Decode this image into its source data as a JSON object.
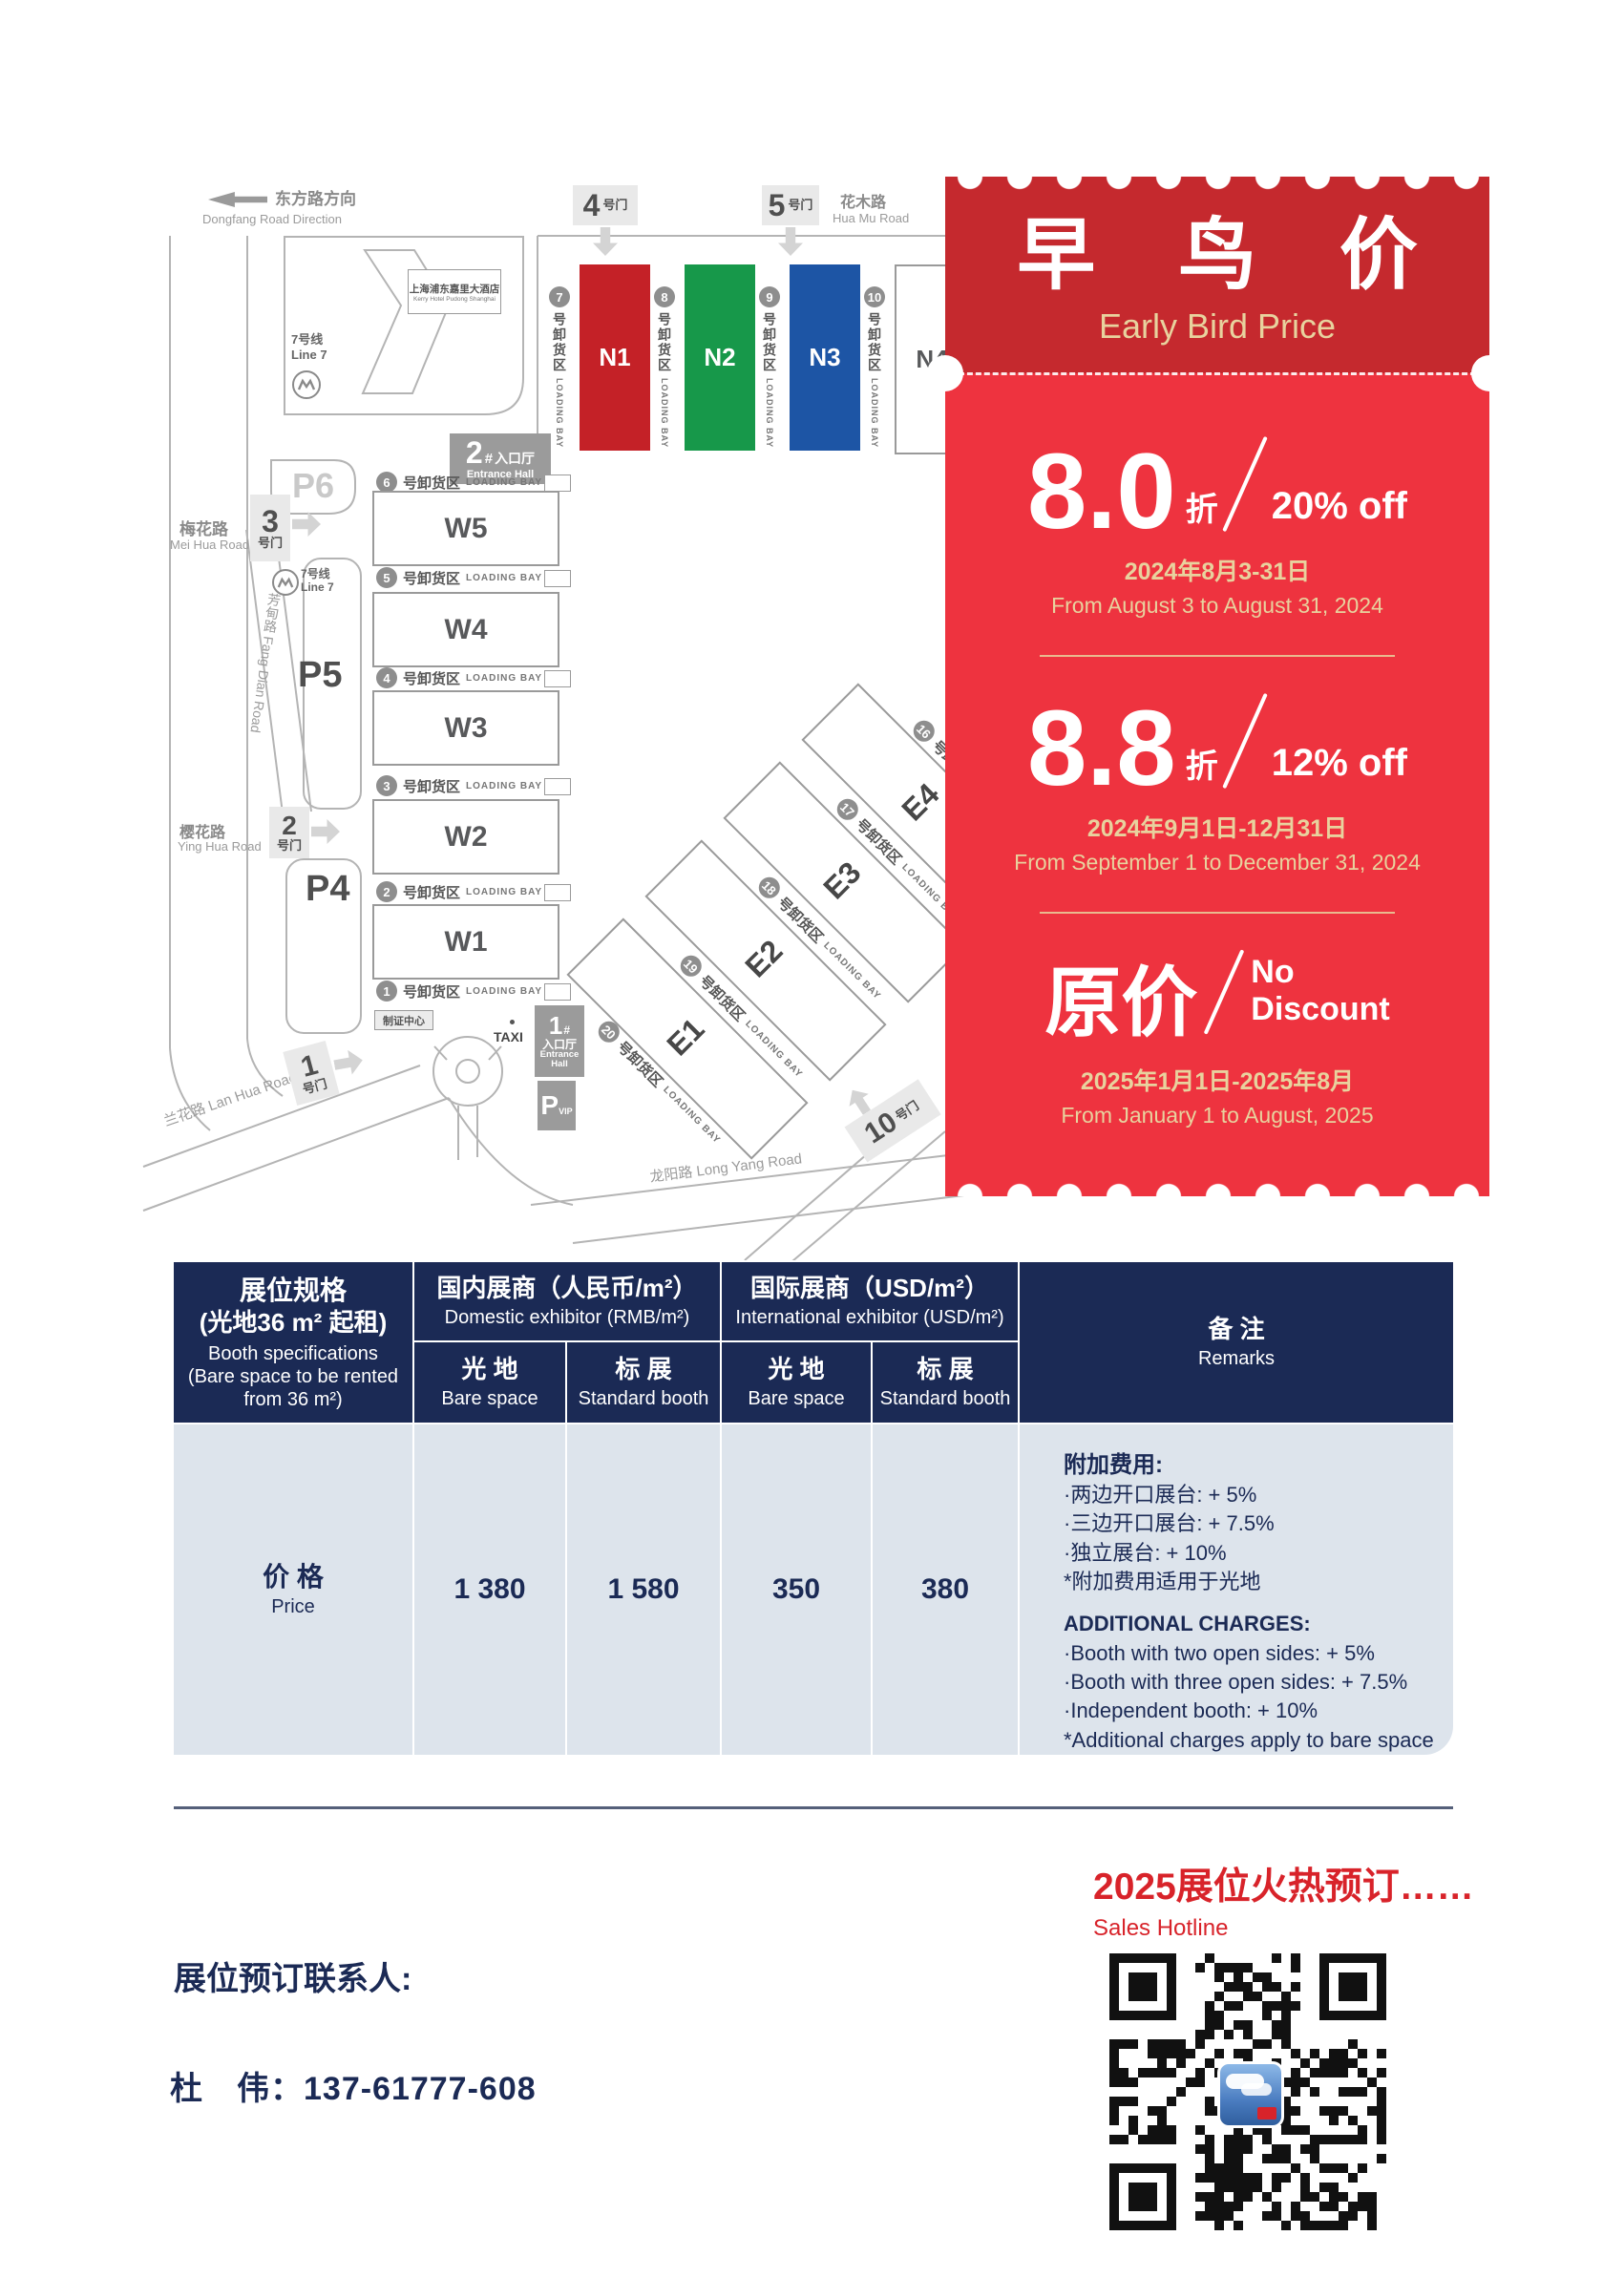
{
  "map": {
    "direction": {
      "zh": "东方路方向",
      "en": "Dongfang Road Direction"
    },
    "hotel": {
      "zh": "上海浦东嘉里大酒店",
      "en": "Kerry Hotel Pudong Shanghai"
    },
    "line7": {
      "zh": "7号线",
      "en": "Line 7"
    },
    "roads": {
      "huamu_zh": "花木路",
      "huamu_en": "Hua Mu Road",
      "meihua_zh": "梅花路",
      "meihua_en": "Mei Hua Road",
      "yinghua_zh": "樱花路",
      "yinghua_en": "Ying Hua Road",
      "lanhua": "兰花路 Lan Hua Road",
      "fangdian": "芳甸路 Fang Dian Road",
      "longyang": "龙阳路 Long Yang Road"
    },
    "gates": {
      "g1": {
        "num": "1",
        "suffix": "号门"
      },
      "g2": {
        "num": "2",
        "suffix": "号门"
      },
      "g3": {
        "num": "3",
        "suffix": "号门"
      },
      "g4": {
        "num": "4",
        "suffix": "号门"
      },
      "g5": {
        "num": "5",
        "suffix": "号门"
      },
      "g10": {
        "num": "10",
        "suffix": "号门"
      }
    },
    "entrances": {
      "e1": {
        "num": "1",
        "hash": "#",
        "zh": "入口厅",
        "en1": "Entrance",
        "en2": "Hall"
      },
      "e2": {
        "num": "2",
        "hash": "#",
        "zh": "入口厅",
        "en": "Entrance Hall"
      }
    },
    "parking": {
      "p4": "P4",
      "p5": "P5",
      "p6": "P6",
      "pvip_p": "P",
      "pvip_sub": "VIP"
    },
    "badge_center": "制证中心",
    "taxi": "TAXI",
    "halls_n": [
      {
        "label": "N1",
        "color": "#c42127"
      },
      {
        "label": "N2",
        "color": "#17984a"
      },
      {
        "label": "N3",
        "color": "#1d55a5"
      },
      {
        "label": "N4",
        "color": "#ffffff"
      }
    ],
    "halls_w": [
      "W5",
      "W4",
      "W3",
      "W2",
      "W1"
    ],
    "halls_e": [
      "E4",
      "E3",
      "E2",
      "E1"
    ],
    "bays_n": [
      "7",
      "8",
      "9",
      "10"
    ],
    "bays_w": [
      "6",
      "5",
      "4",
      "3",
      "2",
      "1"
    ],
    "bays_e": [
      "16",
      "17",
      "18",
      "19",
      "20"
    ],
    "bay_zh": "号卸货区",
    "bay_en": "LOADING BAY"
  },
  "coupon": {
    "header_bg": "#c5292e",
    "body_bg": "#ee333f",
    "gold": "#e8d29e",
    "title_zh": "早 鸟 价",
    "title_en": "Early Bird Price",
    "tier1": {
      "big": "8.0",
      "unit": "折",
      "off": "20% off",
      "date_zh": "2024年8月3-31日",
      "date_en": "From August 3 to August 31, 2024"
    },
    "tier2": {
      "big": "8.8",
      "unit": "折",
      "off": "12% off",
      "date_zh": "2024年9月1日-12月31日",
      "date_en": "From September 1 to December 31, 2024"
    },
    "tier3": {
      "big": "原价",
      "no1": "No",
      "no2": "Discount",
      "date_zh": "2025年1月1日-2025年8月",
      "date_en": "From January 1 to August, 2025"
    }
  },
  "table": {
    "header_bg": "#1b2a55",
    "body_bg": "#dde4ec",
    "spec": {
      "zh1": "展位规格",
      "zh2": "(光地36 m² 起租)",
      "en1": "Booth specifications",
      "en2": "(Bare space to be rented",
      "en3": "from 36 m²)"
    },
    "domestic": {
      "zh": "国内展商（人民币/m²）",
      "en": "Domestic exhibitor (RMB/m²)"
    },
    "international": {
      "zh": "国际展商（USD/m²）",
      "en": "International exhibitor (USD/m²)"
    },
    "sub_bare": {
      "zh": "光 地",
      "en": "Bare space"
    },
    "sub_std": {
      "zh": "标 展",
      "en": "Standard booth"
    },
    "remarks_head": {
      "zh": "备 注",
      "en": "Remarks"
    },
    "row": {
      "zh": "价 格",
      "en": "Price",
      "d_bare": "1 380",
      "d_std": "1 580",
      "i_bare": "350",
      "i_std": "380"
    },
    "remarks": {
      "zh_title": "附加费用:",
      "zh_items": [
        "·两边开口展台: + 5%",
        "·三边开口展台: + 7.5%",
        "·独立展台: + 10%",
        "*附加费用适用于光地"
      ],
      "en_title": "ADDITIONAL CHARGES:",
      "en_items": [
        "·Booth with two open sides: + 5%",
        "·Booth with three open sides: + 7.5%",
        "·Independent booth: + 10%",
        "*Additional charges apply to bare space"
      ]
    }
  },
  "footer": {
    "hotline_zh": "2025展位火热预订……",
    "hotline_en": "Sales Hotline",
    "contact_label": "展位预订联系人:",
    "contact_line": "杜　伟：137-61777-608"
  }
}
